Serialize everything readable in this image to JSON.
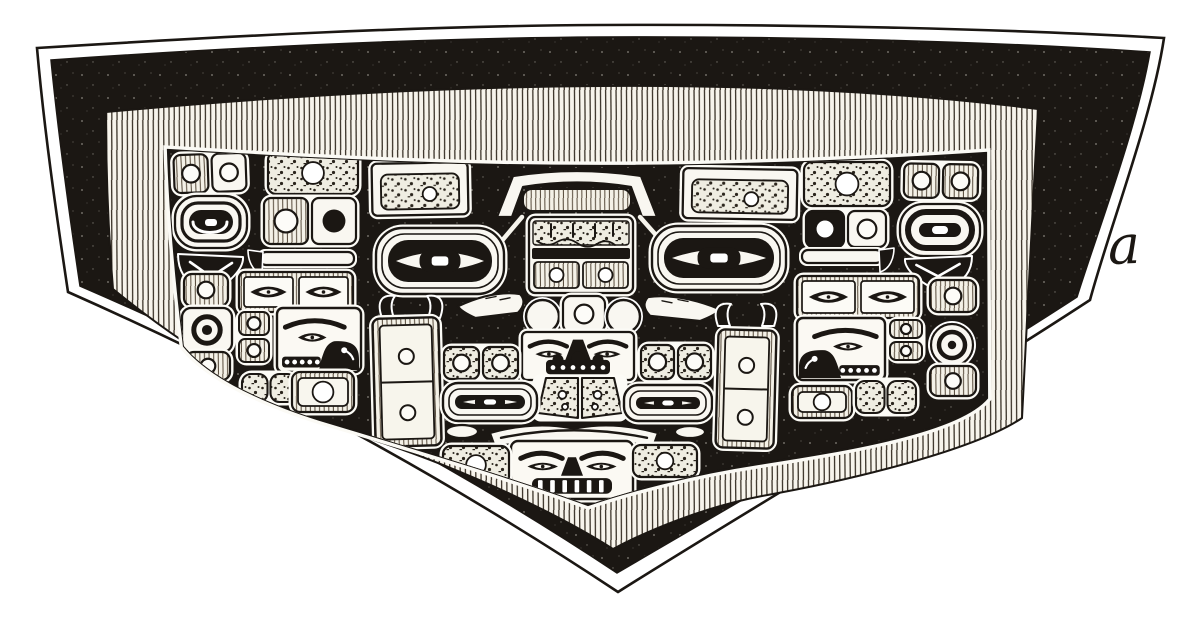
{
  "figure": {
    "caption_label": "a",
    "title": "Chilkat blanket engraving",
    "description": "Black-and-white book-plate engraving of a woven Chilkat ceremonial blanket: five-sided field with formline design (central frontal faces, two flanking profile faces, ovoid eyes, circled boxes) inside a hatched border band and a black outer band"
  },
  "colors": {
    "ink": "#1b1713",
    "paper": "#f9f7f1",
    "page": "#ffffff"
  },
  "canvas": {
    "width": 1200,
    "height": 619
  },
  "motifs": [
    {
      "name": "top-left-box-pair",
      "type": "boxPair",
      "x": 174,
      "y": 154,
      "w": 72,
      "h": 38,
      "o": {
        "rot": -2,
        "cells": [
          {
            "fill": "hatch",
            "dot": "outline"
          },
          {
            "fill": "white",
            "dot": "outline"
          }
        ]
      }
    },
    {
      "name": "top-left-mottled-bar",
      "type": "boxC",
      "x": 268,
      "y": 152,
      "w": 90,
      "h": 42,
      "o": {
        "fill": "stipple",
        "dot": "white"
      }
    },
    {
      "name": "top-left-framed-panel",
      "type": "framedBar",
      "x": 372,
      "y": 163,
      "w": 96,
      "h": 52,
      "o": {
        "rot": -1
      }
    },
    {
      "name": "top-roof",
      "type": "roof",
      "x": 497,
      "y": 167,
      "w": 160,
      "h": 50
    },
    {
      "name": "top-right-framed-panel",
      "type": "framedBar",
      "x": 683,
      "y": 169,
      "w": 114,
      "h": 50,
      "o": {
        "rot": 1
      }
    },
    {
      "name": "top-right-mottled-bar",
      "type": "boxC",
      "x": 804,
      "y": 162,
      "w": 86,
      "h": 44,
      "o": {
        "fill": "stipple",
        "dot": "white"
      }
    },
    {
      "name": "top-right-box-pair",
      "type": "boxPair",
      "x": 904,
      "y": 164,
      "w": 74,
      "h": 34,
      "o": {
        "rot": 1,
        "cells": [
          {
            "fill": "hatch",
            "dot": "outline"
          },
          {
            "fill": "hatch",
            "dot": "outline"
          }
        ]
      }
    },
    {
      "name": "top-center-ticks",
      "type": "ticks",
      "x": 596,
      "y": 150,
      "w": 18,
      "h": 13
    },
    {
      "name": "left-spiral-ovoid",
      "type": "spiral",
      "x": 175,
      "y": 196,
      "w": 72,
      "h": 52
    },
    {
      "name": "left-box-duo",
      "type": "boxPair",
      "x": 264,
      "y": 198,
      "w": 92,
      "h": 46,
      "o": {
        "cells": [
          {
            "fill": "hatch",
            "dot": "outline"
          },
          {
            "fill": "white",
            "dot": "black"
          }
        ]
      }
    },
    {
      "name": "left-tail-fin",
      "type": "tailFin",
      "x": 176,
      "y": 252,
      "w": 70,
      "h": 40
    },
    {
      "name": "left-bar-hook",
      "type": "barHook",
      "x": 248,
      "y": 250,
      "w": 108,
      "h": 38,
      "o": {
        "dir": -1
      }
    },
    {
      "name": "center-fingers-box",
      "type": "fingersBox",
      "x": 529,
      "y": 217,
      "w": 104,
      "h": 76
    },
    {
      "name": "left-slash",
      "type": "slash",
      "x": 500,
      "y": 217,
      "w": 22,
      "h": 26,
      "o": {
        "dir": -1
      }
    },
    {
      "name": "right-slash",
      "type": "slash",
      "x": 640,
      "y": 217,
      "w": 23,
      "h": 26,
      "o": {
        "dir": 1
      }
    },
    {
      "name": "right-duo-pill",
      "type": "boxPair",
      "x": 806,
      "y": 211,
      "w": 80,
      "h": 36,
      "o": {
        "cells": [
          {
            "fill": "ink",
            "dot": "white"
          },
          {
            "fill": "white",
            "dot": "outline"
          }
        ]
      }
    },
    {
      "name": "right-donut-ovoid",
      "type": "donutOvoid",
      "x": 900,
      "y": 204,
      "w": 80,
      "h": 52
    },
    {
      "name": "left-big-eye",
      "type": "bigEye",
      "x": 376,
      "y": 228,
      "w": 128,
      "h": 66
    },
    {
      "name": "right-big-eye",
      "type": "bigEye",
      "x": 652,
      "y": 226,
      "w": 134,
      "h": 64
    },
    {
      "name": "right-bar-hook",
      "type": "barHook",
      "x": 800,
      "y": 248,
      "w": 94,
      "h": 38,
      "o": {
        "dir": 1
      }
    },
    {
      "name": "right-tail-fin",
      "type": "tailFin",
      "x": 902,
      "y": 254,
      "w": 72,
      "h": 36,
      "o": {
        "flip": true
      }
    },
    {
      "name": "left-eye-circle",
      "type": "circleEye",
      "x": 526,
      "y": 300,
      "w": 33,
      "h": 33
    },
    {
      "name": "center-nose-box",
      "type": "boxC",
      "x": 563,
      "y": 296,
      "w": 42,
      "h": 36,
      "o": {
        "fill": "white",
        "dot": "outline"
      }
    },
    {
      "name": "right-eye-circle",
      "type": "circleEye",
      "x": 607,
      "y": 300,
      "w": 33,
      "h": 33
    },
    {
      "name": "left-cheek-wing",
      "type": "wing",
      "x": 458,
      "y": 292,
      "w": 70,
      "h": 26,
      "o": {
        "dir": -1
      }
    },
    {
      "name": "right-cheek-wing",
      "type": "wing",
      "x": 640,
      "y": 295,
      "w": 80,
      "h": 26,
      "o": {
        "dir": 1
      }
    },
    {
      "name": "left-column-box-1",
      "type": "boxC",
      "x": 184,
      "y": 274,
      "w": 44,
      "h": 32,
      "o": {
        "fill": "hatch",
        "dot": "outline"
      }
    },
    {
      "name": "left-eyes-box",
      "type": "eyesBox",
      "x": 239,
      "y": 272,
      "w": 114,
      "h": 40
    },
    {
      "name": "right-eyes-box",
      "type": "eyesBox",
      "x": 797,
      "y": 276,
      "w": 122,
      "h": 42
    },
    {
      "name": "right-column-box-1",
      "type": "boxC",
      "x": 930,
      "y": 280,
      "w": 46,
      "h": 32,
      "o": {
        "fill": "hatch",
        "dot": "outline"
      }
    },
    {
      "name": "left-ring-target",
      "type": "ringTarget",
      "x": 182,
      "y": 308,
      "w": 50,
      "h": 44
    },
    {
      "name": "right-ring-donut",
      "type": "donutSmall",
      "x": 928,
      "y": 324,
      "w": 48,
      "h": 42
    },
    {
      "name": "left-cheek-stack",
      "type": "boxStack",
      "x": 239,
      "y": 312,
      "w": 30,
      "h": 50
    },
    {
      "name": "left-profile-face",
      "type": "faceProfile",
      "x": 277,
      "y": 308,
      "w": 84,
      "h": 64
    },
    {
      "name": "left-horns",
      "type": "horns",
      "x": 376,
      "y": 292,
      "w": 70,
      "h": 26
    },
    {
      "name": "left-door-panel",
      "type": "doorPanel",
      "x": 374,
      "y": 318,
      "w": 66,
      "h": 128,
      "o": {
        "rot": -1.5
      }
    },
    {
      "name": "right-profile-face",
      "type": "faceProfile",
      "x": 797,
      "y": 318,
      "w": 88,
      "h": 62,
      "o": {
        "flip": true
      }
    },
    {
      "name": "right-cheek-stack",
      "type": "boxStack",
      "x": 890,
      "y": 320,
      "w": 32,
      "h": 40
    },
    {
      "name": "left-column-box-2",
      "type": "boxC",
      "x": 186,
      "y": 352,
      "w": 44,
      "h": 28,
      "o": {
        "fill": "hatch",
        "dot": "outline"
      }
    },
    {
      "name": "right-column-box-2",
      "type": "boxC",
      "x": 930,
      "y": 366,
      "w": 46,
      "h": 30,
      "o": {
        "fill": "hatch",
        "dot": "outline"
      }
    },
    {
      "name": "upper-front-face",
      "type": "faceTop",
      "x": 522,
      "y": 332,
      "w": 112,
      "h": 48
    },
    {
      "name": "left-rosette-pair",
      "type": "boxPair",
      "x": 444,
      "y": 347,
      "w": 74,
      "h": 32,
      "o": {
        "cells": [
          {
            "fill": "stipple",
            "dot": "outline"
          },
          {
            "fill": "stipple",
            "dot": "outline"
          }
        ]
      }
    },
    {
      "name": "right-rosette-pair",
      "type": "boxPair",
      "x": 641,
      "y": 345,
      "w": 70,
      "h": 34,
      "o": {
        "cells": [
          {
            "fill": "stipple",
            "dot": "outline"
          },
          {
            "fill": "stipple",
            "dot": "outline"
          }
        ]
      }
    },
    {
      "name": "center-trapezoid-pair",
      "type": "trapPair",
      "x": 536,
      "y": 378,
      "w": 88,
      "h": 40
    },
    {
      "name": "left-mid-eye",
      "type": "bigEye",
      "x": 443,
      "y": 383,
      "w": 94,
      "h": 38
    },
    {
      "name": "right-mid-eye",
      "type": "bigEye",
      "x": 624,
      "y": 385,
      "w": 88,
      "h": 36
    },
    {
      "name": "left-ellipse",
      "type": "ellipseW",
      "x": 446,
      "y": 425,
      "w": 32,
      "h": 13
    },
    {
      "name": "right-ellipse",
      "type": "ellipseW",
      "x": 675,
      "y": 426,
      "w": 30,
      "h": 12
    },
    {
      "name": "mouth-band",
      "type": "mouthBand",
      "x": 488,
      "y": 420,
      "w": 172,
      "h": 27
    },
    {
      "name": "bottom-front-face",
      "type": "faceBottom",
      "x": 511,
      "y": 441,
      "w": 122,
      "h": 58
    },
    {
      "name": "bottom-left-flank-box",
      "type": "boxC",
      "x": 443,
      "y": 446,
      "w": 66,
      "h": 38,
      "o": {
        "fill": "stipple",
        "dot": "white"
      }
    },
    {
      "name": "bottom-right-flank-box",
      "type": "boxC",
      "x": 633,
      "y": 445,
      "w": 64,
      "h": 32,
      "o": {
        "fill": "stipple",
        "dot": "white"
      }
    },
    {
      "name": "right-door-panel",
      "type": "doorPanel",
      "x": 717,
      "y": 330,
      "w": 58,
      "h": 118,
      "o": {
        "rot": 1.5
      }
    },
    {
      "name": "right-horns",
      "type": "horns",
      "x": 712,
      "y": 300,
      "w": 68,
      "h": 26
    },
    {
      "name": "left-lobe-panel",
      "type": "doubleLobe",
      "x": 242,
      "y": 374,
      "w": 54,
      "h": 28
    },
    {
      "name": "left-framed-box",
      "type": "boxC",
      "x": 292,
      "y": 372,
      "w": 62,
      "h": 40,
      "o": {
        "fill": "hatch",
        "dot": "white",
        "frame": true
      }
    },
    {
      "name": "right-box-under-face",
      "type": "boxC",
      "x": 792,
      "y": 386,
      "w": 60,
      "h": 32,
      "o": {
        "fill": "hatch",
        "dot": "white",
        "frame": true
      }
    },
    {
      "name": "right-lobe-panel",
      "type": "doubleLobe",
      "x": 856,
      "y": 381,
      "w": 60,
      "h": 32
    }
  ]
}
